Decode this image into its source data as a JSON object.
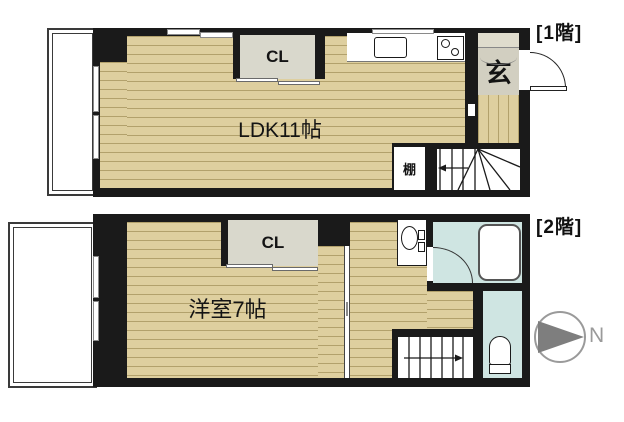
{
  "floor1": {
    "label": "[1階]",
    "ldk_label": "LDK11帖",
    "closet_label": "CL",
    "entrance_label": "玄",
    "shelf_label": "棚"
  },
  "floor2": {
    "label": "[2階]",
    "room_label": "洋室7帖",
    "closet_label": "CL"
  },
  "compass": {
    "north_label": "N"
  },
  "colors": {
    "wall": "#1a1a1a",
    "floor_base": "#decf9f",
    "floor_stripe": "#b2a16c",
    "closet_fill": "#d9d8cc",
    "entrance_tile": "#d2cfc1",
    "entrance_step": "#dfdccd",
    "wet_area": "#cfe5e2",
    "fixture": "#ffffff",
    "compass_gray": "#7e7e7e"
  }
}
